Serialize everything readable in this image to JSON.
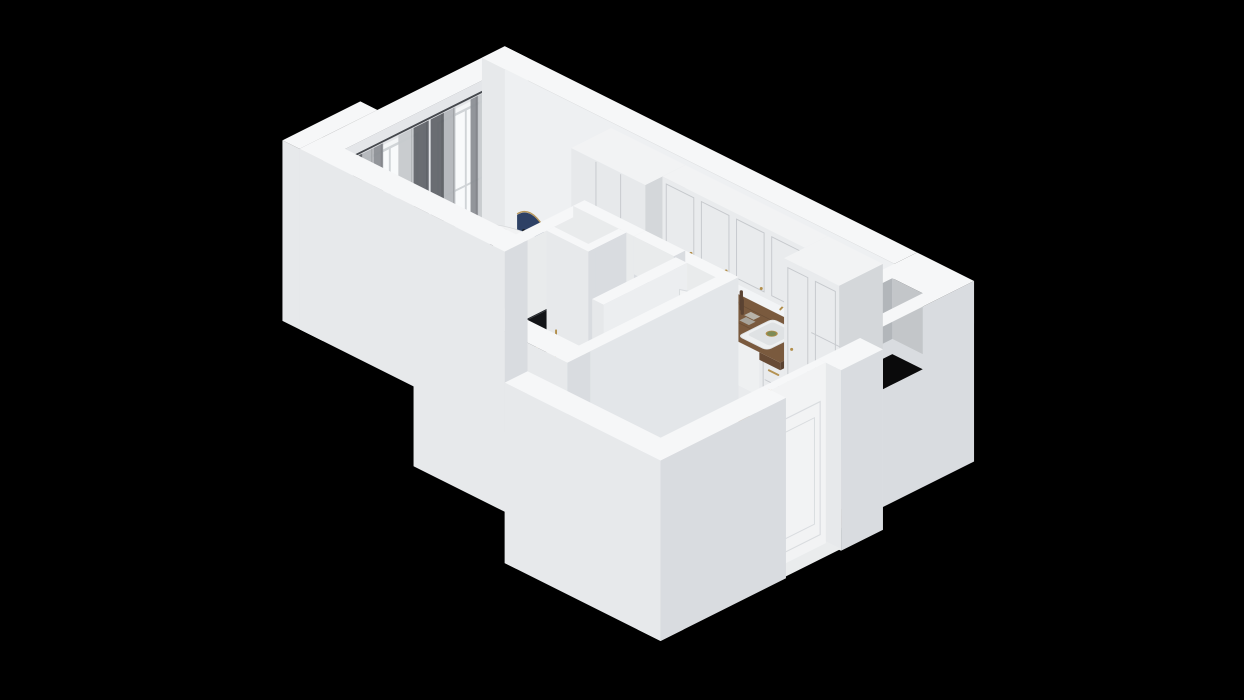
{
  "meta": {
    "background": "#000000",
    "canvas": {
      "w": 1244,
      "h": 700
    },
    "view": "isometric-3d-floorplan"
  },
  "palette": {
    "bg": "#000000",
    "wallTop": "#f6f7f8",
    "wallPX": "#d9dce0",
    "wallPY": "#e7e9eb",
    "wallInnerX": "#e4e6e9",
    "wallInnerY": "#eef0f2",
    "floorA": "#a87c50",
    "floorB": "#936843",
    "floorLine": "rgba(70,45,22,0.35)",
    "rugBase": "#e4e2da",
    "rugNavy": "#333c46",
    "sofaT": "#42577c",
    "sofaPX": "#293a5b",
    "sofaPY": "#31456a",
    "pillowA": "#cdd0d2",
    "pillowB": "#a8acb0",
    "throw": "#eaeae6",
    "chairNavy": "#2e4165",
    "chairDark": "#223253",
    "gold": "#b28e4a",
    "tableTop": "#f1f2f3",
    "tableEdge": "#d8dadc",
    "tableUnder": "#c9cbcd",
    "counterT": "#7a5a3e",
    "counterPX": "#5a4230",
    "counterPY": "#684b35",
    "cabFront": "#e9ebed",
    "cabSeam": "#c6c9cd",
    "cabSide": "#d4d7da",
    "cabTop": "#f2f3f4",
    "kick": "#cdd0d4",
    "oven": "#262220",
    "ovenGlass": "#151210",
    "steel": "#b9bcbf",
    "cooktop": "#1b1d20",
    "cookRing": "#53575c",
    "sinkW": "#eef0f1",
    "sinkIn": "#dfe2e4",
    "drainG": "#7d8b57",
    "coffeeT": "#2e3134",
    "coffeePX": "#0f1113",
    "coffeePY": "#1a1d20",
    "tileBase": "#e9ebec",
    "tileLine": "#cdd0d3",
    "bathFloor": "#b4b7bb",
    "bathLine": "#9da0a4",
    "showerFloor": "#a2a5a9",
    "toiletA": "#e9ebee",
    "toiletB": "#cfd3d6",
    "washer": "#eef0f1",
    "washRing": "#b9bdc1",
    "washEye": "#596067",
    "towel": "#2b4056",
    "towelFold": "#223246",
    "doorFace": "#f2f3f4",
    "doorLine": "#d9dcdf",
    "handle": "#6f747a",
    "tv": "#121417",
    "tvEdge": "#26292e",
    "glass": "#ffffff",
    "winGlass": "#f8fafb",
    "winFrame": "#d0d4d7",
    "curtD": "#64676c",
    "curtM": "#8e9196",
    "curtS": "#c7cacd",
    "curtS2": "#b4b7bb",
    "rod": "#45484d",
    "radiator": "#eef0f2",
    "radSlat": "#d6d9dc",
    "plantA": "#4c8040",
    "plantB": "#6aa34e",
    "pot": "#3a3d40",
    "stem": "#3c5a2f",
    "apple": "#61a93e",
    "appleD": "#4e8f31",
    "plateDark": "#2c2f33",
    "orange": "#d97a2a",
    "flowerY": "#d9b83c",
    "flowerP": "#c05a78",
    "vaseP": "#5a3b63",
    "bottle": "#17191c",
    "plate": "#e8eaec",
    "plateIn": "#97a1ab",
    "mat": "#c2c5c9",
    "matLine": "#afb2b6",
    "grinder": "#5b4332",
    "boxGray": "#b7b3a9",
    "pit": "#070708",
    "shaftIn1": "#b2b6ba",
    "shaftIn2": "#c3c6c9",
    "shaftBottom": "#0a0a0b",
    "warm": "#e2a963"
  },
  "scene": {
    "projection": {
      "ox": 505,
      "oy": 248,
      "wallHeight": 190,
      "scale": 0.95,
      "tx": 25,
      "ty": 14
    },
    "items": [
      {
        "name": "apartment-wood-floor",
        "type": "floor",
        "pts": [
          [
            0,
            0
          ],
          [
            410,
            0
          ],
          [
            410,
            96
          ],
          [
            470,
            96
          ],
          [
            470,
            306
          ],
          [
            342,
            306
          ],
          [
            342,
            96
          ],
          [
            180,
            96
          ],
          [
            180,
            168
          ],
          [
            0,
            168
          ]
        ]
      },
      {
        "name": "floor-light-pools",
        "type": "lights",
        "pools": [
          [
            210,
            60,
            95,
            36,
            "warm",
            0.13
          ],
          [
            40,
            118,
            55,
            38,
            "glass",
            0.09
          ],
          [
            32,
            58,
            46,
            30,
            "glass",
            0.07
          ],
          [
            310,
            190,
            70,
            45,
            "glass",
            0.05
          ],
          [
            392,
            160,
            55,
            70,
            "bg",
            0.12
          ]
        ]
      },
      {
        "name": "bathroom-floor",
        "type": "bathfloor",
        "r": [
          192,
          108,
          330,
          252
        ],
        "shower": [
          252,
          196,
          330,
          252
        ],
        "drain": [
          290,
          228
        ]
      },
      {
        "name": "ventilation-pit",
        "type": "pitrect",
        "r": [
          192,
          108,
          228,
          140
        ]
      },
      {
        "name": "entry-mat",
        "type": "mat",
        "r": [
          412,
          132,
          468,
          226
        ]
      },
      {
        "name": "living-rug",
        "type": "rug",
        "r": [
          24,
          70,
          176,
          166
        ]
      },
      {
        "name": "bath-door-threshold",
        "type": "gstrip",
        "r": [
          246,
          98,
          284,
          107
        ]
      },
      {
        "name": "ambient-occlusion",
        "type": "ao",
        "rects": [
          [
            0,
            0,
            410,
            8,
            0.1
          ],
          [
            0,
            0,
            8,
            168,
            0.08
          ],
          [
            0,
            160,
            180,
            168,
            0.12
          ],
          [
            170,
            96,
            180,
            252,
            0.12
          ],
          [
            180,
            88,
            342,
            96,
            0.1
          ],
          [
            344,
            96,
            352,
            306,
            0.07
          ],
          [
            462,
            96,
            470,
            306,
            0.07
          ],
          [
            412,
            298,
            468,
            306,
            0.08
          ],
          [
            112,
            42,
            398,
            54,
            0.13
          ]
        ]
      },
      {
        "name": "furniture-shadows",
        "type": "shadows",
        "es": [
          [
            58,
            62,
            54,
            38,
            0.2
          ],
          [
            118,
            114,
            30,
            22,
            0.22
          ],
          [
            36,
            22,
            11,
            8,
            0.16
          ],
          [
            78,
            22,
            11,
            8,
            0.16
          ],
          [
            32,
            100,
            11,
            8,
            0.16
          ],
          [
            76,
            100,
            11,
            8,
            0.16
          ],
          [
            114,
            60,
            11,
            8,
            0.16
          ],
          [
            219,
            178,
            17,
            12,
            0.18
          ],
          [
            188,
            56,
            7,
            5,
            0.2
          ],
          [
            168,
            100,
            7,
            5,
            0.2
          ]
        ],
        "rs": [
          [
            8,
            86,
            148,
            172,
            0.26
          ],
          [
            166,
            112,
            186,
            196,
            0.28
          ],
          [
            190,
            146,
            240,
            252,
            0.13
          ],
          [
            286,
            108,
            304,
            200,
            0.13
          ],
          [
            300,
            130,
            332,
            198,
            0.11
          ]
        ]
      },
      {
        "name": "window-wall",
        "type": "wallbox",
        "boxes": [
          {
            "r": [
              -24,
              -24,
              0,
              192
            ]
          },
          {
            "r": [
              -42,
              110,
              -24,
              192
            ],
            "nopx": true
          }
        ],
        "innerX": {
          "x": 0,
          "y0": 0,
          "y1": 192
        }
      },
      {
        "name": "windows-and-curtains",
        "type": "windows",
        "bays": [
          [
            6,
            76
          ],
          [
            86,
            156
          ]
        ],
        "radiator": [
          0,
          112,
          9,
          150
        ]
      },
      {
        "name": "kitchen-wall",
        "type": "wallbox",
        "boxes": [
          {
            "r": [
              -24,
              -24,
              410,
              0
            ],
            "nopx": true
          }
        ],
        "innerY": {
          "y": 0,
          "x0": 0,
          "x1": 410
        },
        "backsplash": [
          190,
          340,
          76,
          110
        ]
      },
      {
        "name": "utility-block-with-shaft",
        "type": "block",
        "r": [
          410,
          -24,
          470,
          96
        ],
        "hole": [
          424,
          16,
          456,
          60
        ]
      },
      {
        "name": "wardrobe",
        "type": "wardrobe",
        "r": [
          112,
          0,
          190,
          42
        ],
        "h": 184,
        "seams": [
          138,
          164
        ]
      },
      {
        "name": "kitchen-base-and-counter",
        "type": "kbase",
        "r": [
          190,
          0,
          340,
          46
        ],
        "h": 68,
        "seams": [
          212,
          256,
          288,
          318
        ],
        "drawers": [
          [
            190,
            212
          ],
          [
            256,
            288
          ],
          [
            318,
            340
          ]
        ],
        "oven": [
          214,
          256
        ],
        "counter": [
          190,
          0,
          340,
          50
        ],
        "sink": [
          288,
          318
        ],
        "cooktop": [
          212,
          256
        ],
        "coffee": [
          322,
          336
        ],
        "apples": [
          203,
          20
        ],
        "grinders": [
          [
            263,
            14
          ],
          [
            268,
            18
          ]
        ],
        "boxes": [
          [
            271,
            12
          ],
          [
            274,
            20
          ]
        ]
      },
      {
        "name": "kitchen-upper-cabinets",
        "type": "kupper",
        "r": [
          190,
          0,
          340,
          24
        ],
        "z0": 110,
        "z1": 184,
        "doors": [
          [
            190,
            227
          ],
          [
            227,
            264
          ],
          [
            264,
            301
          ],
          [
            301,
            340
          ]
        ]
      },
      {
        "name": "kitchen-tall-cabinets",
        "type": "ktall",
        "r": [
          340,
          0,
          398,
          46
        ],
        "h": 184,
        "doors": [
          [
            340,
            369
          ],
          [
            369,
            398
          ]
        ]
      },
      {
        "name": "plant-by-kitchen",
        "type": "plant",
        "p": [
          188,
          56
        ]
      },
      {
        "name": "dining-set",
        "type": "dining",
        "center": [
          58,
          58
        ],
        "rx": 50,
        "ry": 31,
        "chairs": [
          [
            36,
            22,
            "N"
          ],
          [
            78,
            22,
            "N"
          ],
          [
            32,
            100,
            "S"
          ],
          [
            76,
            100,
            "S"
          ],
          [
            114,
            60,
            "E"
          ]
        ],
        "plates": [
          [
            36,
            42
          ],
          [
            42,
            72
          ],
          [
            70,
            74
          ],
          [
            76,
            40
          ],
          [
            92,
            58
          ]
        ]
      },
      {
        "name": "sofa",
        "type": "sofa"
      },
      {
        "name": "coffee-table",
        "type": "ctable",
        "c": [
          118,
          112
        ],
        "r": 26
      },
      {
        "name": "plant-by-tv",
        "type": "plant",
        "p": [
          168,
          100
        ]
      },
      {
        "name": "bathroom-west-wall",
        "type": "wallbox",
        "boxes": [
          {
            "r": [
              180,
              96,
              192,
              252
            ],
            "pxc": "#e9ebec"
          }
        ]
      },
      {
        "name": "tv",
        "type": "tv"
      },
      {
        "name": "bathroom-north-wall",
        "type": "wallbox",
        "boxes": [
          {
            "r": [
              180,
              96,
              244,
              108
            ],
            "pyc": "#e9ebec"
          },
          {
            "r": [
              286,
              96,
              342,
              108
            ],
            "pyc": "#e9ebec",
            "nopx": true
          }
        ],
        "header": [
          244,
          286,
          150
        ],
        "tiled": [
          286,
          342
        ]
      },
      {
        "name": "shaft-niche-walls",
        "type": "wallbox",
        "boxes": [
          {
            "r": [
              228,
              108,
              236,
              148
            ]
          },
          {
            "r": [
              192,
              140,
              236,
              148
            ]
          }
        ]
      },
      {
        "name": "bathroom-fixtures",
        "type": "bathfix"
      },
      {
        "name": "bathroom-east-wall",
        "type": "wallbox",
        "boxes": [
          {
            "r": [
              330,
              96,
              342,
              330
            ],
            "pxc": "#e3e6e9"
          }
        ]
      },
      {
        "name": "bathroom-south-wall",
        "type": "wallbox",
        "boxes": [
          {
            "r": [
              180,
              252,
              342,
              276
            ]
          }
        ]
      },
      {
        "name": "living-south-wall",
        "type": "wallbox",
        "boxes": [
          {
            "r": [
              -24,
              168,
              192,
              192
            ]
          }
        ]
      },
      {
        "name": "entry-south-wall",
        "type": "wallbox",
        "boxes": [
          {
            "r": [
              330,
              306,
              494,
              330
            ]
          }
        ]
      },
      {
        "name": "entry-wall-and-door",
        "type": "sewall"
      }
    ]
  }
}
